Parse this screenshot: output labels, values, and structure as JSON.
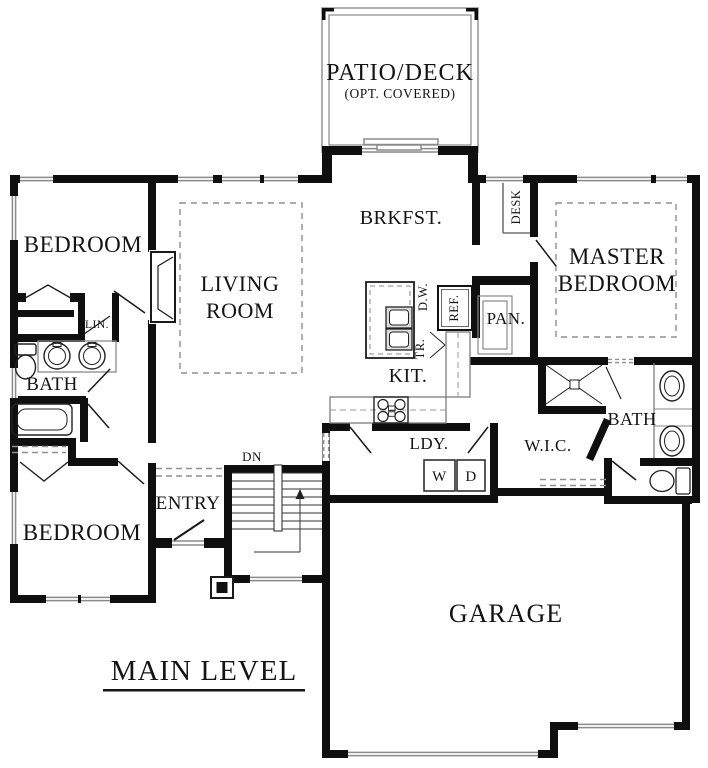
{
  "title": {
    "label": "MAIN LEVEL"
  },
  "rooms": {
    "patio": {
      "name": "PATIO/DECK",
      "note": "(OPT. COVERED)"
    },
    "breakfast": {
      "name": "BRKFST."
    },
    "desk": {
      "name": "DESK"
    },
    "master_bedroom": {
      "name_line1": "MASTER",
      "name_line2": "BEDROOM"
    },
    "bedroom_upper": {
      "name": "BEDROOM"
    },
    "living_room": {
      "name_line1": "LIVING",
      "name_line2": "ROOM"
    },
    "linen": {
      "name": "LIN."
    },
    "bath_hall": {
      "name": "BATH"
    },
    "pantry": {
      "name": "PAN."
    },
    "kitchen": {
      "name": "KIT."
    },
    "dishwasher": {
      "name": "D.W."
    },
    "trash": {
      "name": "TR."
    },
    "refrigerator": {
      "name": "REF."
    },
    "laundry": {
      "name": "LDY.",
      "washer": "W",
      "dryer": "D"
    },
    "walk_in_closet": {
      "name": "W.I.C."
    },
    "bath_master": {
      "name": "BATH"
    },
    "entry": {
      "name": "ENTRY"
    },
    "stairs": {
      "direction": "DN"
    },
    "bedroom_lower": {
      "name": "BEDROOM"
    },
    "garage": {
      "name": "GARAGE"
    }
  },
  "colors": {
    "wall": "#0f0f0f",
    "thin_line": "#222222",
    "light_line": "#8a8a8a",
    "dashed_line": "#999999",
    "background": "#ffffff"
  }
}
